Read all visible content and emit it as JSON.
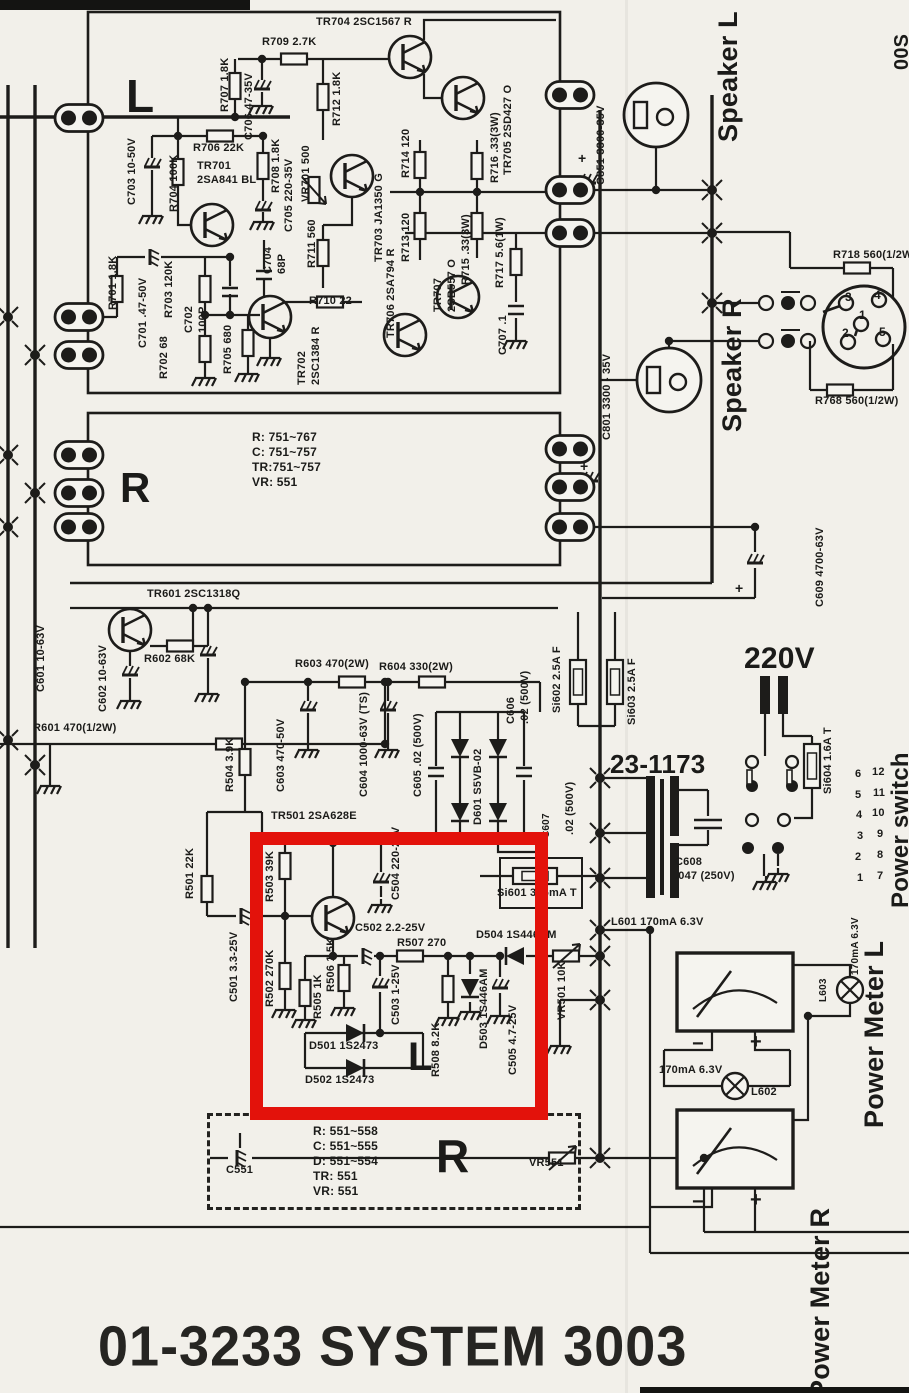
{
  "document": {
    "title": "01-3233 SYSTEM 3003",
    "page_marker": "00S"
  },
  "highlight": {
    "color": "#e3120b"
  },
  "labels": [
    {
      "id": "tr704",
      "t": "TR704 2SC1567 R",
      "x": 316,
      "y": 16
    },
    {
      "id": "r709",
      "t": "R709 2.7K",
      "x": 262,
      "y": 36
    },
    {
      "id": "r706",
      "t": "R706 22K",
      "x": 193,
      "y": 142
    },
    {
      "id": "tr701",
      "t": "TR701\n2SA841 BL",
      "x": 197,
      "y": 160
    },
    {
      "id": "r710",
      "t": "R710 22",
      "x": 309,
      "y": 295
    },
    {
      "id": "tr601",
      "t": "TR601 2SC1318Q",
      "x": 147,
      "y": 588
    },
    {
      "id": "r602",
      "t": "R602 68K",
      "x": 144,
      "y": 653
    },
    {
      "id": "r601",
      "t": "R601 470(1/2W)",
      "x": 33,
      "y": 722
    },
    {
      "id": "r603",
      "t": "R603 470(2W)",
      "x": 295,
      "y": 658
    },
    {
      "id": "r604",
      "t": "R604 330(2W)",
      "x": 379,
      "y": 661
    },
    {
      "id": "tr501",
      "t": "TR501 2SA628E",
      "x": 271,
      "y": 810
    },
    {
      "id": "box751",
      "t": "R: 751~767\nC: 751~757\nTR:751~757\nVR: 551",
      "x": 252,
      "y": 430,
      "s": 12
    },
    {
      "id": "c502",
      "t": "C502 2.2-25V",
      "x": 355,
      "y": 922
    },
    {
      "id": "r507",
      "t": "R507 270",
      "x": 397,
      "y": 937
    },
    {
      "id": "d504",
      "t": "D504 1S446AM",
      "x": 476,
      "y": 929
    },
    {
      "id": "d501",
      "t": "D501 1S2473",
      "x": 309,
      "y": 1040
    },
    {
      "id": "d502",
      "t": "D502 1S2473",
      "x": 305,
      "y": 1074
    },
    {
      "id": "l601",
      "t": "L601 170mA 6.3V",
      "x": 611,
      "y": 916
    },
    {
      "id": "si601",
      "t": "Si601 315mA T",
      "x": 497,
      "y": 887
    },
    {
      "id": "t2311",
      "t": "23-1173",
      "x": 610,
      "y": 748,
      "s": 26
    },
    {
      "id": "v220",
      "t": "220V",
      "x": 744,
      "y": 640,
      "s": 30
    },
    {
      "id": "c608",
      "t": "C608\n.047 (250V)",
      "x": 675,
      "y": 856
    },
    {
      "id": "r718",
      "t": "R718 560(1/2W)",
      "x": 833,
      "y": 249
    },
    {
      "id": "r768",
      "t": "R768 560(1/2W)",
      "x": 815,
      "y": 395
    },
    {
      "id": "ma62",
      "t": "170mA 6.3V",
      "x": 659,
      "y": 1064
    },
    {
      "id": "l602",
      "t": "L602",
      "x": 751,
      "y": 1086
    },
    {
      "id": "box551",
      "t": "R: 551~558\nC: 551~555\nD: 551~554\nTR: 551\nVR: 551",
      "x": 313,
      "y": 1124,
      "s": 12
    },
    {
      "id": "c551",
      "t": "C551",
      "x": 226,
      "y": 1164
    },
    {
      "id": "vr551",
      "t": "VR551",
      "x": 529,
      "y": 1157
    },
    {
      "id": "bigL1",
      "t": "L",
      "x": 126,
      "y": 68,
      "s": 46
    },
    {
      "id": "bigR1",
      "t": "R",
      "x": 120,
      "y": 462,
      "s": 42
    },
    {
      "id": "bigL2",
      "t": "L",
      "x": 408,
      "y": 1032,
      "s": 40
    },
    {
      "id": "bigR2",
      "t": "R",
      "x": 436,
      "y": 1128,
      "s": 46
    },
    {
      "id": "din3",
      "t": "3",
      "x": 845,
      "y": 290,
      "s": 12
    },
    {
      "id": "din4",
      "t": "4",
      "x": 874,
      "y": 288,
      "s": 12
    },
    {
      "id": "din1",
      "t": "1",
      "x": 859,
      "y": 308,
      "s": 12
    },
    {
      "id": "din2",
      "t": "2",
      "x": 842,
      "y": 326,
      "s": 12
    },
    {
      "id": "din5",
      "t": "5",
      "x": 879,
      "y": 325,
      "s": 12
    },
    {
      "id": "swL1",
      "t": "6",
      "x": 855,
      "y": 768
    },
    {
      "id": "swR1",
      "t": "12",
      "x": 872,
      "y": 766
    },
    {
      "id": "swL2",
      "t": "5",
      "x": 855,
      "y": 789
    },
    {
      "id": "swR2",
      "t": "11",
      "x": 873,
      "y": 787
    },
    {
      "id": "swL3",
      "t": "4",
      "x": 856,
      "y": 809
    },
    {
      "id": "swR3",
      "t": "10",
      "x": 872,
      "y": 807
    },
    {
      "id": "swL4",
      "t": "3",
      "x": 857,
      "y": 830
    },
    {
      "id": "swR4",
      "t": "9",
      "x": 877,
      "y": 828
    },
    {
      "id": "swL5",
      "t": "2",
      "x": 855,
      "y": 851
    },
    {
      "id": "swR5",
      "t": "8",
      "x": 877,
      "y": 849
    },
    {
      "id": "swL6",
      "t": "1",
      "x": 857,
      "y": 872
    },
    {
      "id": "swR6",
      "t": "7",
      "x": 877,
      "y": 870
    },
    {
      "id": "mLm",
      "t": "−",
      "x": 692,
      "y": 1032,
      "s": 20
    },
    {
      "id": "mLp",
      "t": "+",
      "x": 750,
      "y": 1030,
      "s": 20
    },
    {
      "id": "mRm",
      "t": "−",
      "x": 692,
      "y": 1190,
      "s": 20
    },
    {
      "id": "mRp",
      "t": "+",
      "x": 750,
      "y": 1188,
      "s": 20
    },
    {
      "id": "c851p",
      "t": "+",
      "x": 578,
      "y": 150,
      "s": 14
    },
    {
      "id": "c801p",
      "t": "+",
      "x": 580,
      "y": 458,
      "s": 14
    },
    {
      "id": "c609p",
      "t": "+",
      "x": 735,
      "y": 580,
      "s": 14
    },
    {
      "id": "r707",
      "t": "R707 1.8K",
      "x": 219,
      "y": 112,
      "v": 1
    },
    {
      "id": "c706",
      "t": "C706 47-35V",
      "x": 243,
      "y": 140,
      "v": 1
    },
    {
      "id": "r712",
      "t": "R712 1.8K",
      "x": 331,
      "y": 126,
      "v": 1
    },
    {
      "id": "c703",
      "t": "C703 10-50V",
      "x": 126,
      "y": 205,
      "v": 1
    },
    {
      "id": "r704",
      "t": "R704 100K",
      "x": 168,
      "y": 212,
      "v": 1
    },
    {
      "id": "r708",
      "t": "R708 1.8K",
      "x": 270,
      "y": 193,
      "v": 1
    },
    {
      "id": "c705",
      "t": "C705 220-35V",
      "x": 283,
      "y": 232,
      "v": 1
    },
    {
      "id": "vr701",
      "t": "VR701 500",
      "x": 300,
      "y": 202,
      "v": 1
    },
    {
      "id": "tr703",
      "t": "TR703 JA1350 G",
      "x": 373,
      "y": 262,
      "v": 1
    },
    {
      "id": "r714",
      "t": "R714 120",
      "x": 400,
      "y": 178,
      "v": 1
    },
    {
      "id": "r713",
      "t": "R713 120",
      "x": 400,
      "y": 262,
      "v": 1
    },
    {
      "id": "tr706",
      "t": "TR706 2SA794 R",
      "x": 385,
      "y": 338,
      "v": 1
    },
    {
      "id": "r716",
      "t": "R716 .33(3W)",
      "x": 489,
      "y": 183,
      "v": 1
    },
    {
      "id": "tr705",
      "t": "TR705 2SD427 O",
      "x": 502,
      "y": 175,
      "v": 1
    },
    {
      "id": "tr707",
      "t": "TR707\n2SB557 O",
      "x": 432,
      "y": 312,
      "v": 1
    },
    {
      "id": "r715",
      "t": "R715 .33(3W)",
      "x": 460,
      "y": 285,
      "v": 1
    },
    {
      "id": "r717",
      "t": "R717 5.6(1W)",
      "x": 494,
      "y": 288,
      "v": 1
    },
    {
      "id": "c707",
      "t": "C707 .1",
      "x": 497,
      "y": 355,
      "v": 1
    },
    {
      "id": "c851",
      "t": "C851 3300-35V",
      "x": 595,
      "y": 185,
      "v": 1
    },
    {
      "id": "c801",
      "t": "C801 3300 - 35V",
      "x": 601,
      "y": 440,
      "v": 1
    },
    {
      "id": "r701",
      "t": "R701 1.8K",
      "x": 107,
      "y": 310,
      "v": 1
    },
    {
      "id": "c701",
      "t": "C701 .47-50V",
      "x": 137,
      "y": 348,
      "v": 1
    },
    {
      "id": "r703",
      "t": "R703 120K",
      "x": 163,
      "y": 318,
      "v": 1
    },
    {
      "id": "c702",
      "t": "C702\n100P",
      "x": 183,
      "y": 333,
      "v": 1
    },
    {
      "id": "r702",
      "t": "R702 68",
      "x": 158,
      "y": 379,
      "v": 1
    },
    {
      "id": "r705",
      "t": "R705 680",
      "x": 222,
      "y": 374,
      "v": 1
    },
    {
      "id": "c704",
      "t": "C704\n68P",
      "x": 262,
      "y": 274,
      "v": 1
    },
    {
      "id": "r711",
      "t": "R711 560",
      "x": 306,
      "y": 268,
      "v": 1
    },
    {
      "id": "tr702",
      "t": "TR702\n2SC1384 R",
      "x": 296,
      "y": 385,
      "v": 1
    },
    {
      "id": "c601",
      "t": "C601 10-63V",
      "x": 35,
      "y": 692,
      "v": 1
    },
    {
      "id": "c602",
      "t": "C602 10-63V",
      "x": 97,
      "y": 712,
      "v": 1
    },
    {
      "id": "r504",
      "t": "R504 3.9K",
      "x": 224,
      "y": 792,
      "v": 1
    },
    {
      "id": "c603",
      "t": "C603 470-50V",
      "x": 275,
      "y": 792,
      "v": 1
    },
    {
      "id": "c604",
      "t": "C604 1000-63V (TS)",
      "x": 358,
      "y": 797,
      "v": 1
    },
    {
      "id": "c605",
      "t": "C605 .02 (500V)",
      "x": 412,
      "y": 797,
      "v": 1
    },
    {
      "id": "d601",
      "t": "D601 S5VB-02",
      "x": 472,
      "y": 825,
      "v": 1
    },
    {
      "id": "c606",
      "t": "C606\n.02 (500V)",
      "x": 505,
      "y": 724,
      "v": 1
    },
    {
      "id": "si602",
      "t": "Si602 2.5A F",
      "x": 551,
      "y": 713,
      "v": 1
    },
    {
      "id": "si603",
      "t": "Si603 2.5A F",
      "x": 626,
      "y": 725,
      "v": 1
    },
    {
      "id": "c607",
      "t": "C607",
      "x": 541,
      "y": 838,
      "v": 1,
      "s": 10
    },
    {
      "id": "c607b",
      "t": ".02 (500V)",
      "x": 564,
      "y": 835,
      "v": 1
    },
    {
      "id": "si604",
      "t": "Si604 1.6A T",
      "x": 822,
      "y": 794,
      "v": 1
    },
    {
      "id": "c609",
      "t": "C609 4700-63V",
      "x": 814,
      "y": 607,
      "v": 1
    },
    {
      "id": "r501",
      "t": "R501 22K",
      "x": 184,
      "y": 899,
      "v": 1
    },
    {
      "id": "c501",
      "t": "C501 3.3-25V",
      "x": 228,
      "y": 1002,
      "v": 1
    },
    {
      "id": "r503",
      "t": "R503 39K",
      "x": 264,
      "y": 902,
      "v": 1
    },
    {
      "id": "r502",
      "t": "R502 270K",
      "x": 264,
      "y": 1007,
      "v": 1
    },
    {
      "id": "r505",
      "t": "R505 1K",
      "x": 312,
      "y": 1019,
      "v": 1
    },
    {
      "id": "r506",
      "t": "R506 1.5K",
      "x": 325,
      "y": 992,
      "v": 1
    },
    {
      "id": "c503",
      "t": "C503 1-25V",
      "x": 390,
      "y": 1025,
      "v": 1
    },
    {
      "id": "c504",
      "t": "C504 220-25V",
      "x": 390,
      "y": 900,
      "v": 1
    },
    {
      "id": "r508",
      "t": "R508 8.2K",
      "x": 430,
      "y": 1077,
      "v": 1
    },
    {
      "id": "d503",
      "t": "D503 1S446AM",
      "x": 478,
      "y": 1049,
      "v": 1
    },
    {
      "id": "c505",
      "t": "C505 4.7-25V",
      "x": 507,
      "y": 1075,
      "v": 1
    },
    {
      "id": "vr501",
      "t": "VR501 10K",
      "x": 556,
      "y": 1020,
      "v": 1
    },
    {
      "id": "l603",
      "t": "L603",
      "x": 818,
      "y": 1002,
      "v": 1,
      "s": 10
    },
    {
      "id": "ma63",
      "t": "170mA 6.3V",
      "x": 850,
      "y": 975,
      "v": 1,
      "s": 10
    },
    {
      "id": "spkL",
      "t": "Speaker L",
      "x": 712,
      "y": 142,
      "v": 1,
      "s": 27
    },
    {
      "id": "spkR",
      "t": "Speaker R",
      "x": 716,
      "y": 432,
      "v": 1,
      "s": 27
    },
    {
      "id": "pmL",
      "t": "Power Meter L",
      "x": 858,
      "y": 1128,
      "v": 1,
      "s": 27
    },
    {
      "id": "pmR",
      "t": "Power Meter R",
      "x": 804,
      "y": 1398,
      "v": 1,
      "s": 27
    },
    {
      "id": "psw",
      "t": "Power switch",
      "x": 886,
      "y": 908,
      "v": 1,
      "s": 24
    },
    {
      "id": "pagemark",
      "t": "00S",
      "x": 890,
      "y": 70,
      "v": 1,
      "s": 20
    }
  ]
}
